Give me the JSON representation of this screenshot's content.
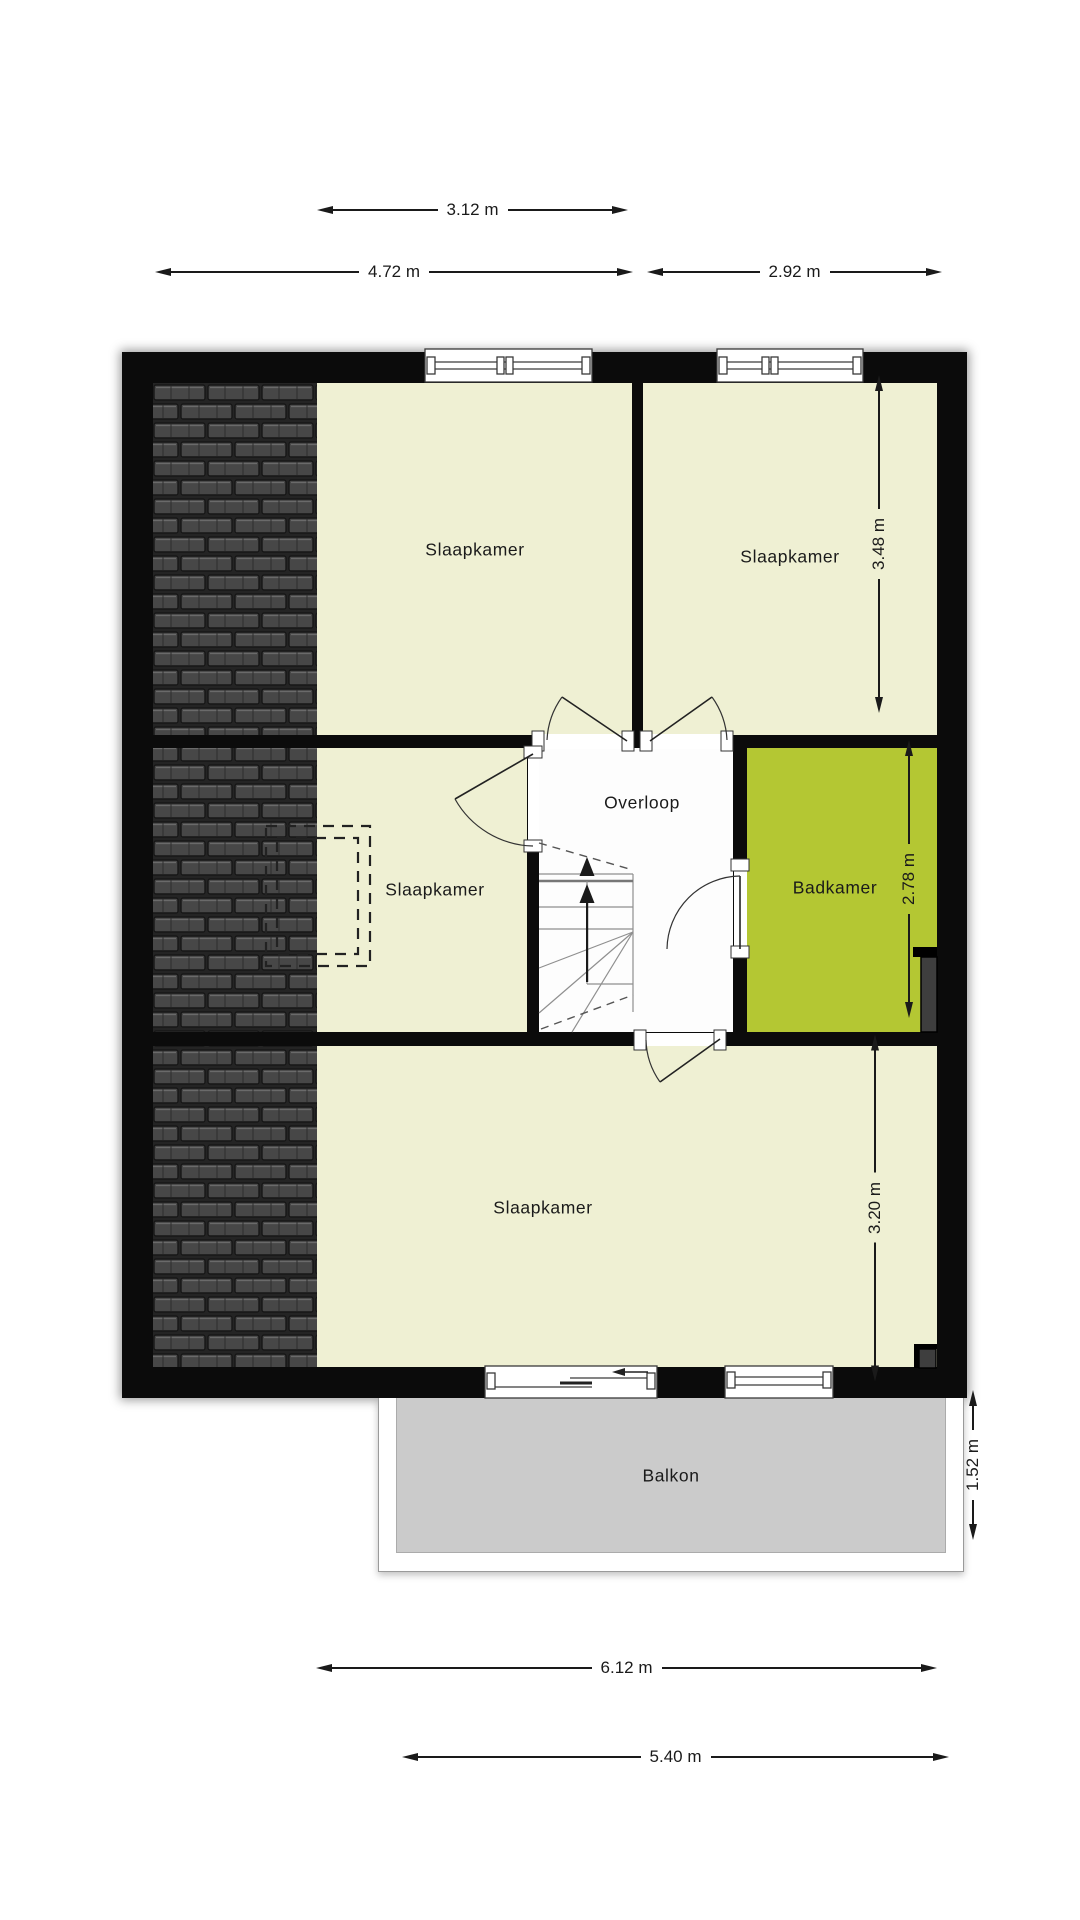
{
  "plan": {
    "rooms": [
      {
        "id": "slaapkamer_top_left",
        "label": "Slaapkamer"
      },
      {
        "id": "slaapkamer_top_right",
        "label": "Slaapkamer"
      },
      {
        "id": "overloop",
        "label": "Overloop"
      },
      {
        "id": "slaapkamer_mid_left",
        "label": "Slaapkamer"
      },
      {
        "id": "badkamer",
        "label": "Badkamer"
      },
      {
        "id": "slaapkamer_bottom",
        "label": "Slaapkamer"
      },
      {
        "id": "balkon",
        "label": "Balkon"
      }
    ]
  },
  "dimensions": {
    "top_room_width": "3.12 m",
    "top_left_width": "4.72 m",
    "top_right_width": "2.92 m",
    "left_middle_height": "2.81 m",
    "right_top_height": "3.48 m",
    "right_middle_height": "2.78 m",
    "right_bottom_height": "3.20 m",
    "right_balcony_height": "1.52 m",
    "bottom_house_width": "6.12 m",
    "bottom_balcony_width": "5.40 m"
  },
  "colors": {
    "wall": "#0b0b0b",
    "room_fill": "#eff0d3",
    "bathroom_fill": "#b4c733",
    "hall_fill": "#fdfdfd",
    "roof_fill": "#262626",
    "balcony_fill": "#cbcbcb"
  }
}
